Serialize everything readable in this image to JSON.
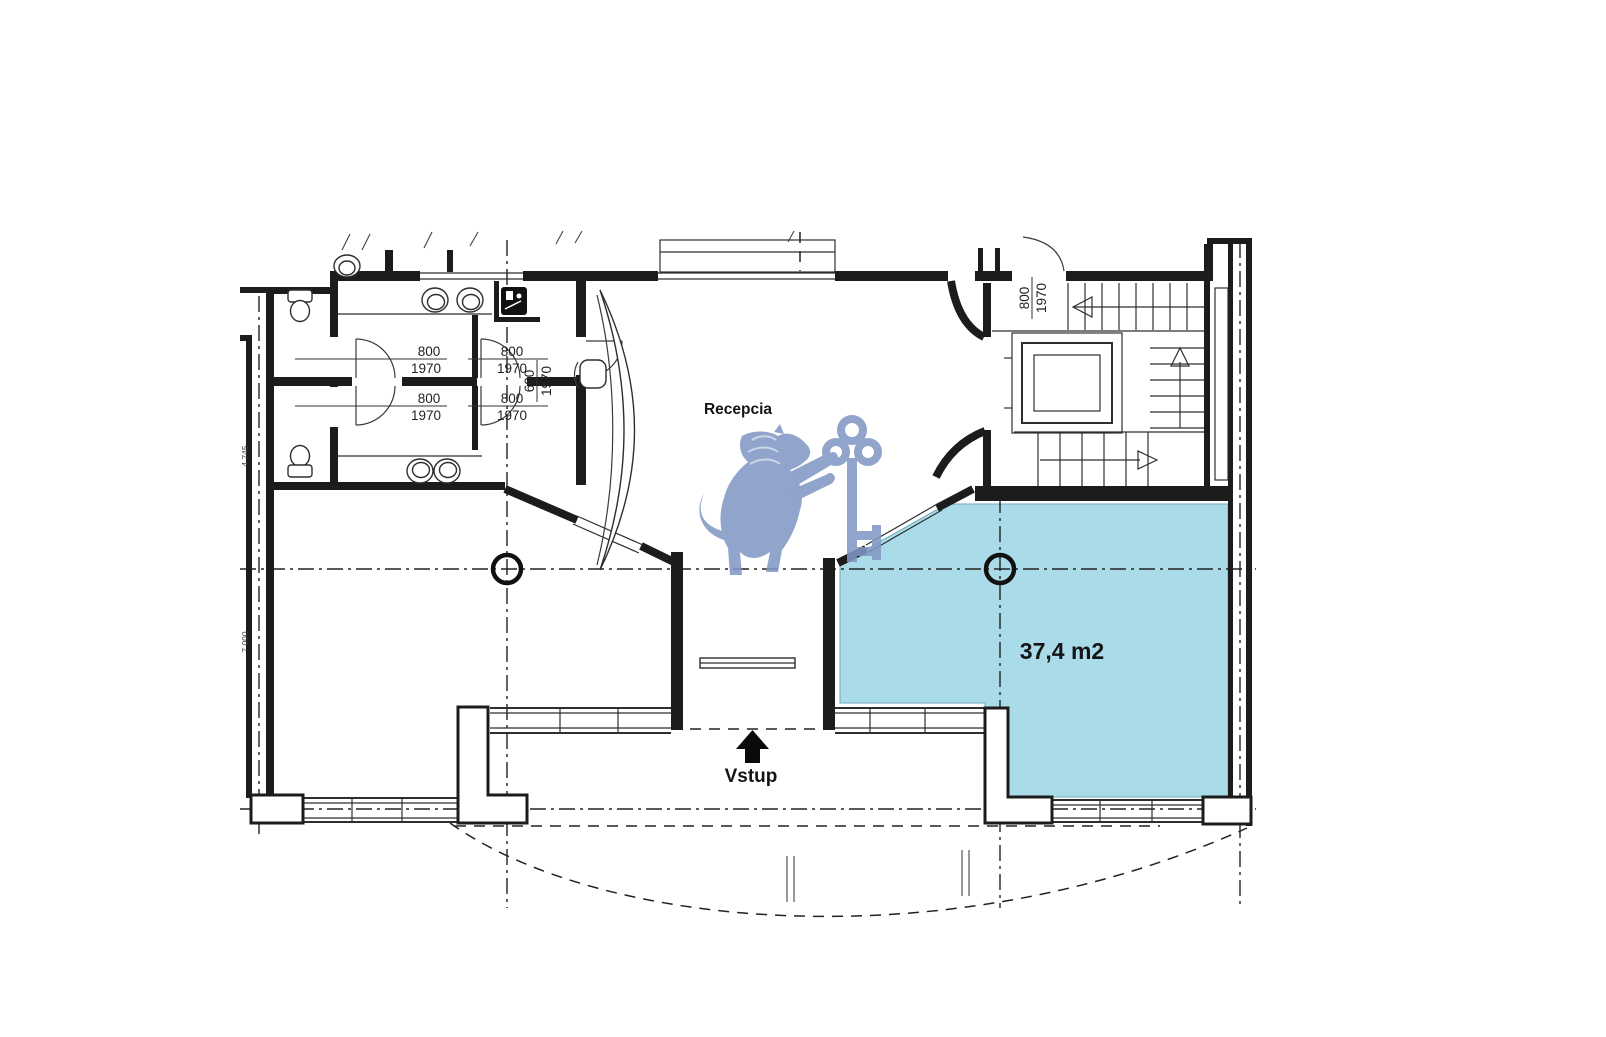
{
  "plan": {
    "reception_label": "Recepcia",
    "highlighted_area_label": "37,4 m2",
    "entrance_label": "Vstup",
    "doors": {
      "wc_door_1": {
        "w": "800",
        "h": "1970"
      },
      "wc_door_2": {
        "w": "800",
        "h": "1970"
      },
      "wc_door_3": {
        "w": "800",
        "h": "1970"
      },
      "wc_door_4": {
        "w": "800",
        "h": "1970"
      },
      "closet_door": {
        "w": "600",
        "h": "1970"
      },
      "stair_door": {
        "w": "800",
        "h": "1970"
      }
    },
    "edge_dimensions": {
      "upper": "4 745",
      "lower": "7 000"
    },
    "colors": {
      "highlight": "#A9DBE9",
      "watermark": "#8298C4",
      "wall": "#1C1C1C",
      "area_text": "#17263F"
    }
  }
}
